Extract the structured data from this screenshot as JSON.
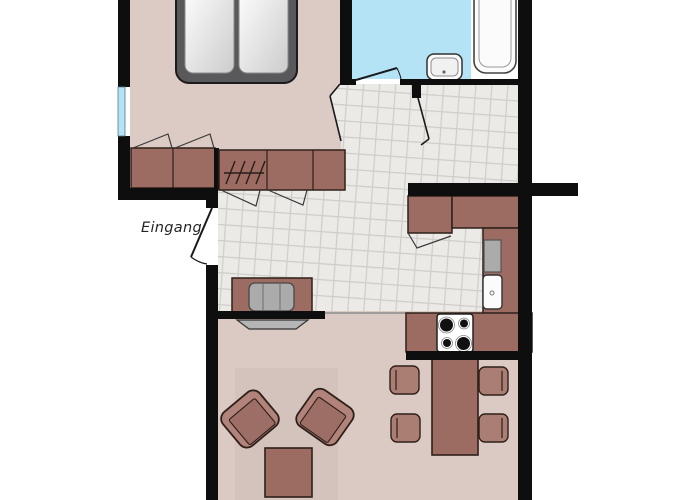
{
  "floorplan": {
    "entrance_label": "Eingang",
    "rooms": [
      {
        "id": "bedroom"
      },
      {
        "id": "bathroom"
      },
      {
        "id": "hallway"
      },
      {
        "id": "kitchen"
      },
      {
        "id": "living-room"
      }
    ],
    "furniture": [
      "double-bed",
      "bedroom-wardrobe",
      "hall-wardrobe-with-hangers",
      "window",
      "washbasin",
      "bathtub",
      "kitchen-counter",
      "stove-4-burners",
      "kitchen-sink",
      "dishwasher",
      "sideboard",
      "media-device",
      "tv",
      "armchair",
      "armchair",
      "coffee-table",
      "rug",
      "dining-table",
      "dining-chair",
      "dining-chair",
      "dining-chair",
      "dining-chair",
      "entrance-door",
      "bathroom-door",
      "bedroom-door"
    ],
    "colors": {
      "wall": "#0e0e0e",
      "outline": "#2e2019",
      "bedroom_floor": "#dccac4",
      "living_floor": "#dbc9c3",
      "rug": "#d4c2bc",
      "bathroom_floor": "#b5e3f6",
      "window_blue": "#b5e3f6",
      "tile_floor": "#eceae7",
      "tile_line": "#cfcdc9",
      "furniture": "#9c6c62",
      "furniture_light": "#b1837a",
      "furniture_mid": "#aa7e73",
      "seat": "#9d6e65",
      "bed_frame": "#59595b",
      "appliance_gray": "#ababab",
      "tv_gray": "#b5b5b5",
      "fixture_white": "#fbfbfb"
    }
  }
}
